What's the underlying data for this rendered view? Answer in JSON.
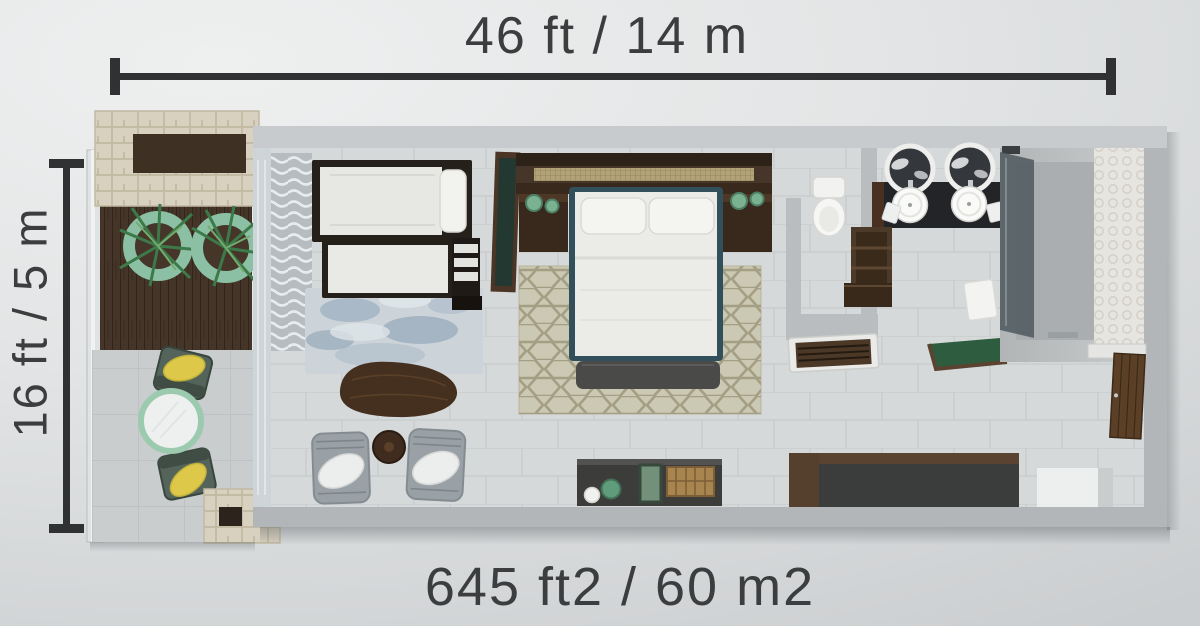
{
  "page": {
    "background": "#e2e4e5"
  },
  "labels": {
    "width_dimension": "46 ft / 14 m",
    "depth_dimension": "16 ft / 5 m",
    "area": "645 ft2 / 60 m2"
  },
  "colors": {
    "text": "#3b3d3e",
    "dimension": "#2f3132",
    "background": "#e2e4e5",
    "wall": "#b2b6b9",
    "wall_top": "#c7cbce",
    "floor": "#d6d9da",
    "wood_dark": "#4b3526",
    "wood_mid": "#5a4330",
    "deck": "#453528",
    "stone": "#d8d1bf",
    "plant_green": "#3c7a49",
    "planter_ring": "#8cc0a4",
    "cushion_yellow": "#ddc84a",
    "bed_trim": "#31505b",
    "rug_blue": "#9db0c0",
    "rug_hex": "#cbc8b3",
    "vanity": "#222427",
    "mat_green": "#2e5c3e",
    "linen_white": "#ebebe8"
  },
  "objects": [
    "balcony",
    "planter-wall",
    "palm-planters",
    "outdoor-chairs",
    "outdoor-table",
    "wood-deck",
    "stone-pillar",
    "curtains",
    "daybed",
    "trundle-bed",
    "step-ladder",
    "blue-area-rug",
    "tv-panel",
    "coffee-table",
    "side-table",
    "armchairs",
    "console-cabinet",
    "headboard",
    "nightstands",
    "table-lamps",
    "double-bed",
    "foot-bench",
    "hex-area-rug",
    "toilet",
    "double-vanity",
    "mirrors",
    "shelf-unit",
    "luggage-bench",
    "bath-mats",
    "walk-in-shower",
    "entry-door",
    "closet-console"
  ]
}
